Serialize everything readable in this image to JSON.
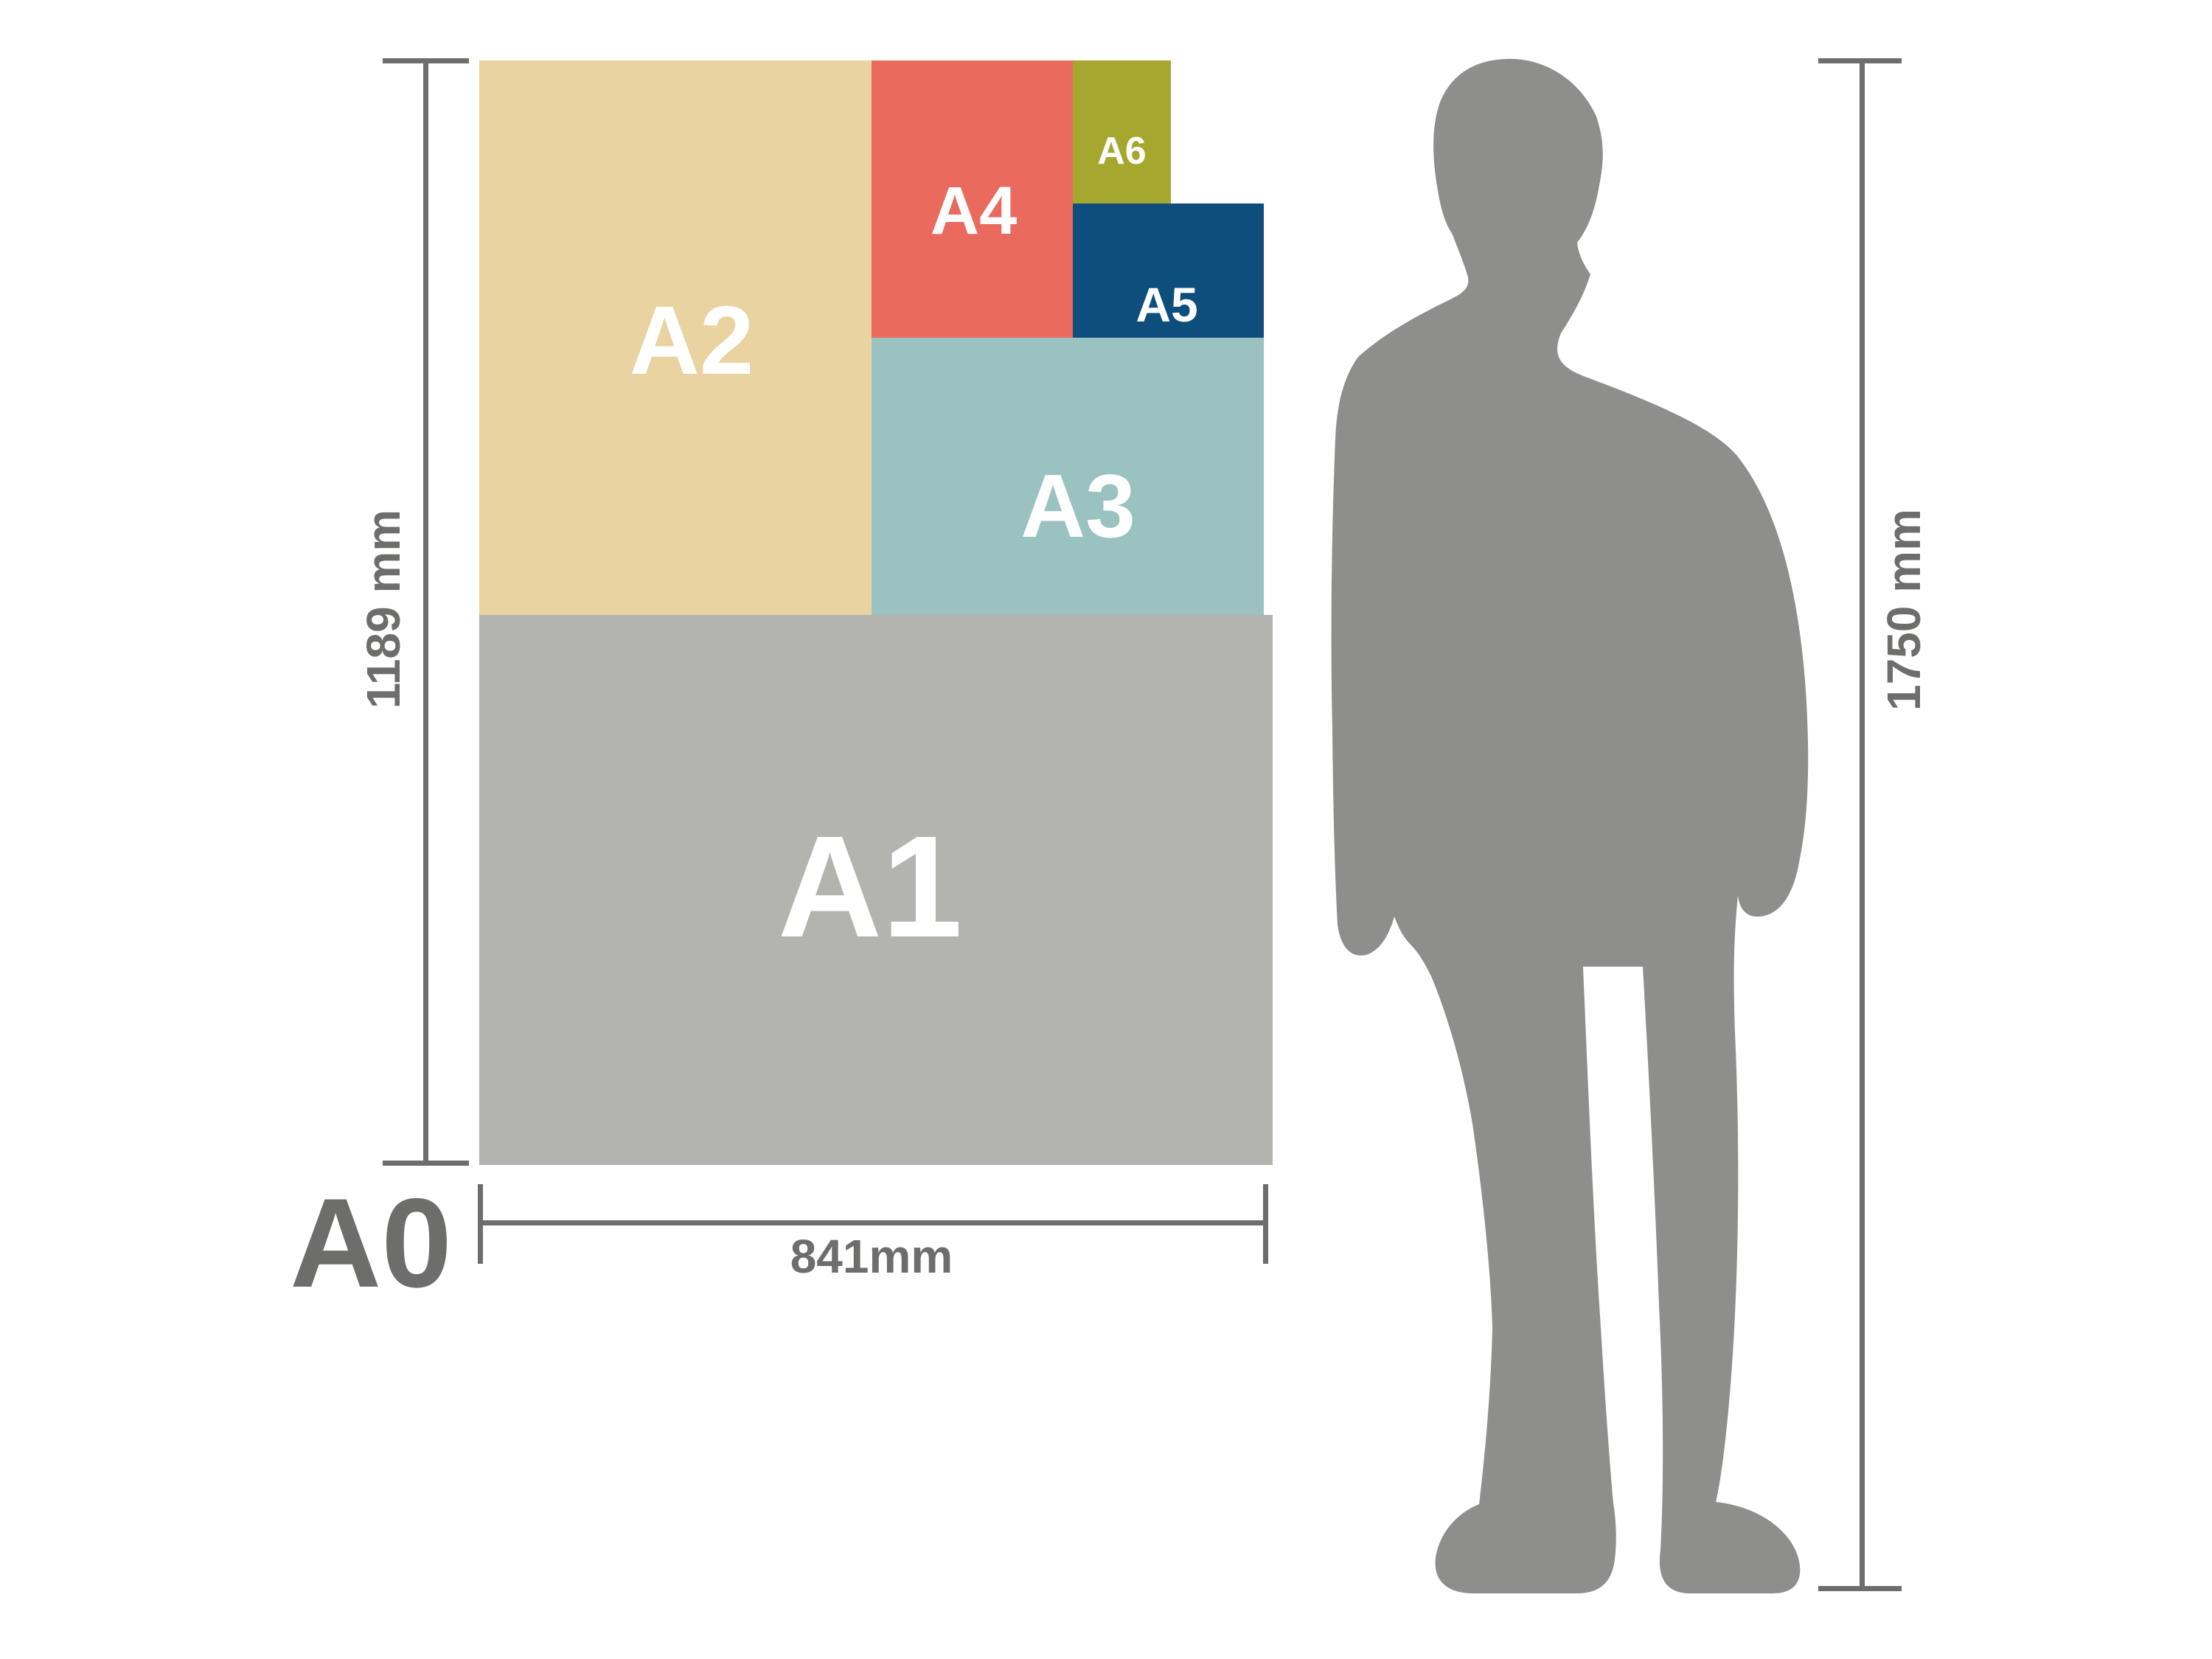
{
  "diagram": {
    "base_label": "A0",
    "panels": [
      {
        "id": "a2",
        "label": "A2",
        "color": "#e9d3a1"
      },
      {
        "id": "a4",
        "label": "A4",
        "color": "#ea6a5e"
      },
      {
        "id": "a6",
        "label": "A6",
        "color": "#a6a72f"
      },
      {
        "id": "a5",
        "label": "A5",
        "color": "#0e4e7d"
      },
      {
        "id": "a3",
        "label": "A3",
        "color": "#9ac2c0"
      },
      {
        "id": "a1",
        "label": "A1",
        "color": "#b3b3b0"
      }
    ],
    "dimensions": {
      "a0_height": "1189 mm",
      "a0_width": "841mm",
      "person_height": "1750 mm"
    },
    "colors": {
      "background": "#ffffff",
      "dimension_line": "#6d6d6b",
      "panel_label_text": "#ffffff",
      "base_label_text": "#6d6d6b",
      "silhouette": "#8e8e8c"
    }
  }
}
